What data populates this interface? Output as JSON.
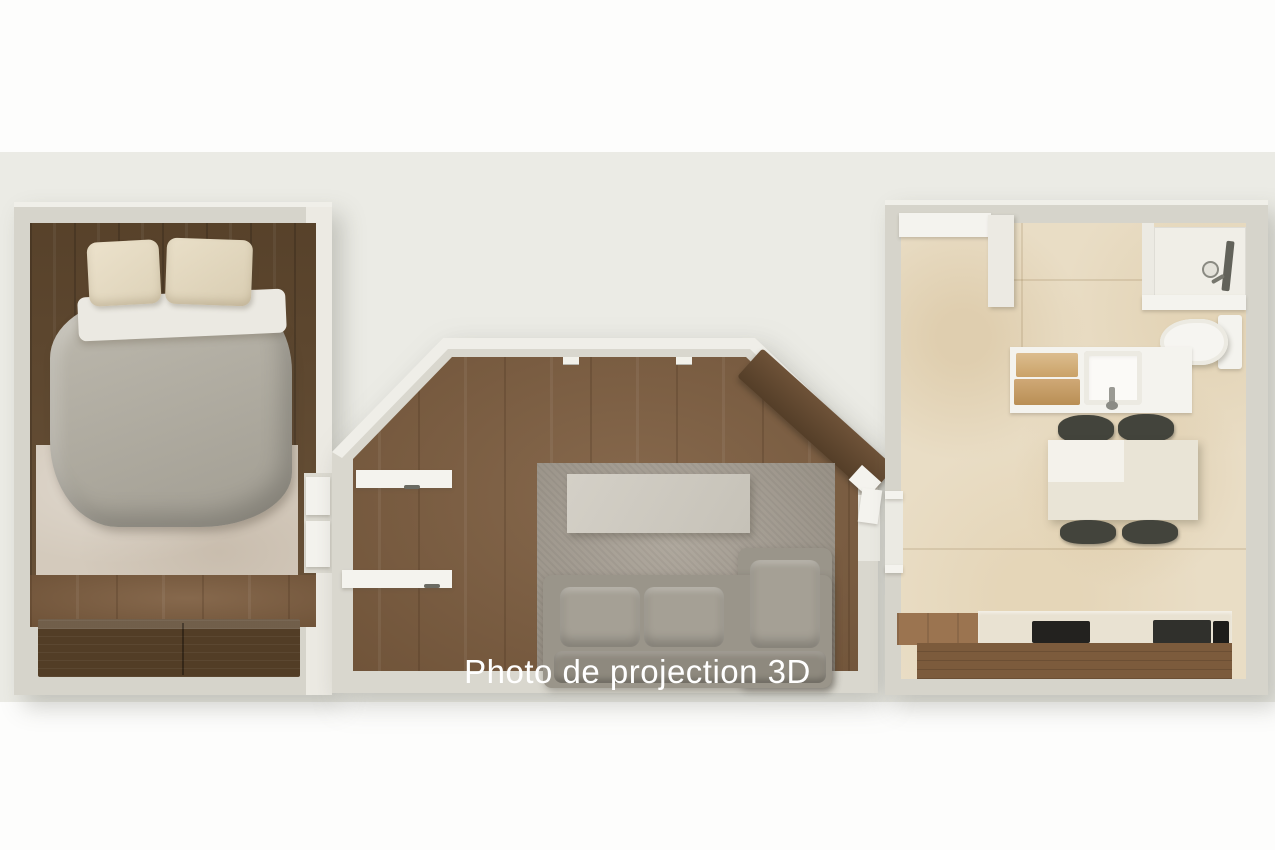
{
  "caption": {
    "label": "Photo de projection 3D",
    "color": "#ffffff"
  },
  "scene": {
    "type": "3d-floor-plan-render",
    "rooms": [
      "bedroom",
      "living-room",
      "kitchen-dining-bathroom"
    ]
  },
  "palette": {
    "page_bg": "#ffffff",
    "photo_bg": "#ebebe5",
    "wall": "#d6d4cb",
    "wall_face": "#eceae3",
    "wood_dark": "#61492f",
    "wood_floor": "#7d5d3f",
    "wood_cabinet_front": "#7c5b3c",
    "dresser": "#564028",
    "carpet": "#d4cabc",
    "rug": "#a69e92",
    "duvet": "#b0aca1",
    "pillow": "#e7ddc6",
    "sheet": "#ebe9e2",
    "sofa": "#9a958a",
    "sideboard": "#cfcbc2",
    "marble_floor": "#e9ddc5",
    "fixture_white": "#f4f3ee",
    "towel_wood": "#d2b183",
    "chair": "#43443c",
    "appliance_dark": "#26251f",
    "caption_text": "#ffffff"
  }
}
